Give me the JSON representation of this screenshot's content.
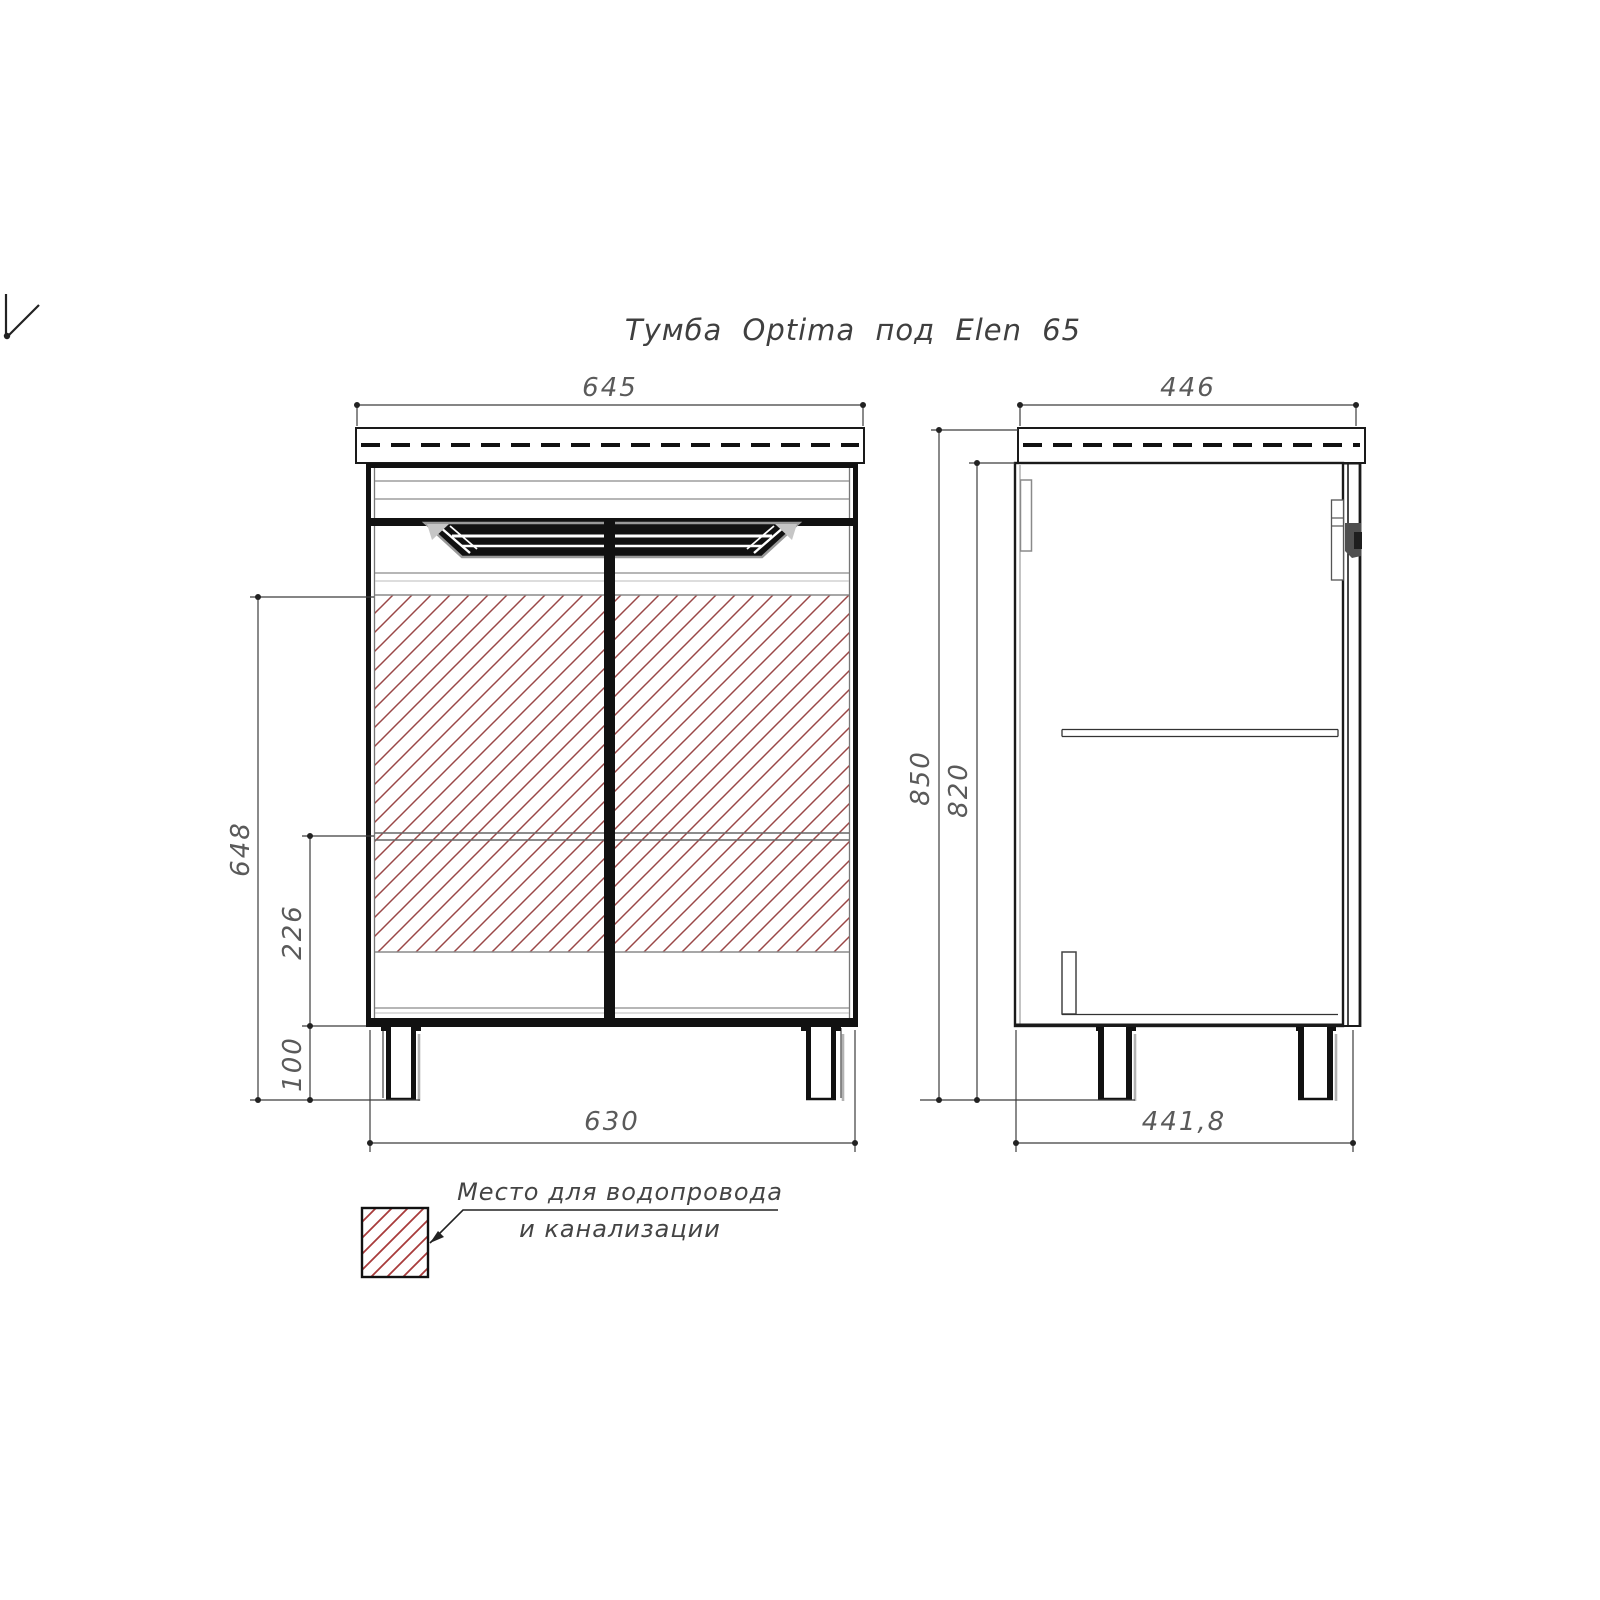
{
  "title": "Тумба Optima под Elen 65",
  "views": {
    "front": {
      "dimensions": {
        "top_width": "645",
        "bottom_width": "630",
        "hatch_zone_height": "648",
        "shelf_to_bottom": "226",
        "leg_height": "100"
      }
    },
    "side": {
      "dimensions": {
        "top_depth": "446",
        "bottom_depth": "441,8",
        "total_height": "850",
        "body_height": "820"
      }
    }
  },
  "legend": {
    "label_line1": "Место для водопровода",
    "label_line2": "и канализации"
  },
  "colors": {
    "hatch_red": "#9a4747",
    "legend_red": "#a83b3b",
    "line_black": "#141414",
    "dim_gray": "#5a5a5a"
  }
}
